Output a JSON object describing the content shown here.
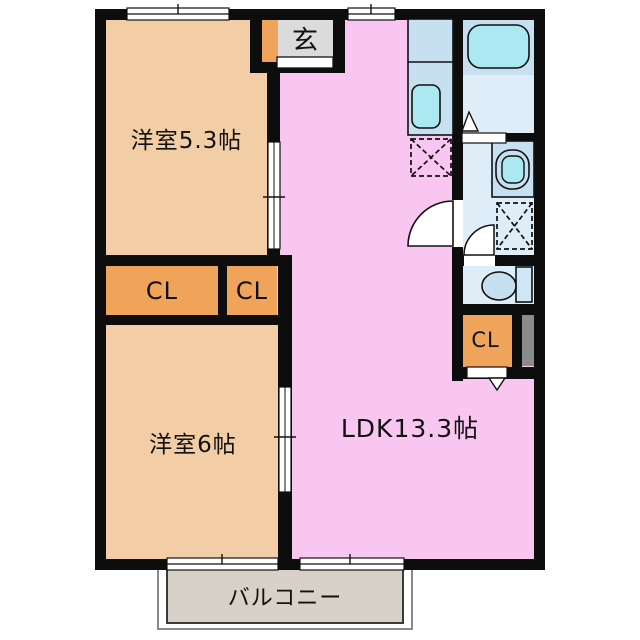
{
  "plan": {
    "type": "apartment-floorplan",
    "rooms": {
      "bedroom1": {
        "label": "洋室5.3帖"
      },
      "bedroom2": {
        "label": "洋室6帖"
      },
      "ldk": {
        "label": "LDK13.3帖"
      },
      "entrance": {
        "label": "玄"
      },
      "closet_hall_left": {
        "label": "CL"
      },
      "closet_hall_right": {
        "label": "CL"
      },
      "closet_ldk": {
        "label": "CL"
      },
      "balcony": {
        "label": "バルコニー"
      }
    },
    "fixtures": [
      "bathtub",
      "kitchen-counter",
      "kitchen-sink",
      "vanity-sink",
      "toilet",
      "washing-machine-space",
      "refrigerator-space",
      "entrance-door",
      "window",
      "sliding-door",
      "hinged-door-arc",
      "door-swing-triangle"
    ],
    "colors": {
      "wall": "#0d0d0d",
      "bedroom": "#f2cda5",
      "ldk": "#f8c6f1",
      "closet": "#efa35b",
      "entrance-floor": "#dbdbdb",
      "balcony-floor": "#d8d1c8",
      "wet-floor": "#deedf8",
      "fixture-blue": "#c6dff1",
      "basin-cyan": "#abe8f2",
      "closet-bar": "#8b8b8b"
    }
  }
}
